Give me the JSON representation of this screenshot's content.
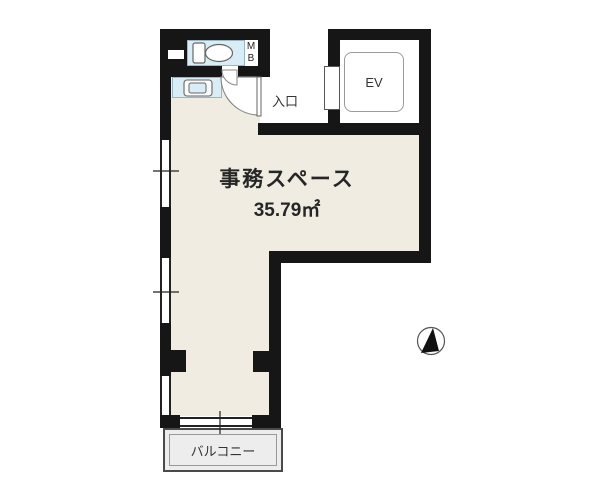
{
  "floorplan": {
    "office": {
      "label": "事務スペース",
      "area": "35.79㎡"
    },
    "entrance_label": "入口",
    "elevator_label": "EV",
    "meter_box": {
      "line1": "M",
      "line2": "B"
    },
    "balcony_label": "バルコニー",
    "icons": [
      "toilet-icon",
      "sink-icon",
      "north-arrow-icon"
    ],
    "colors": {
      "wall": "#161616",
      "office_fill": "#f1ece2",
      "wet_area_fill": "#d9edf6",
      "balcony_fill": "#ededed",
      "background": "#ffffff"
    }
  }
}
